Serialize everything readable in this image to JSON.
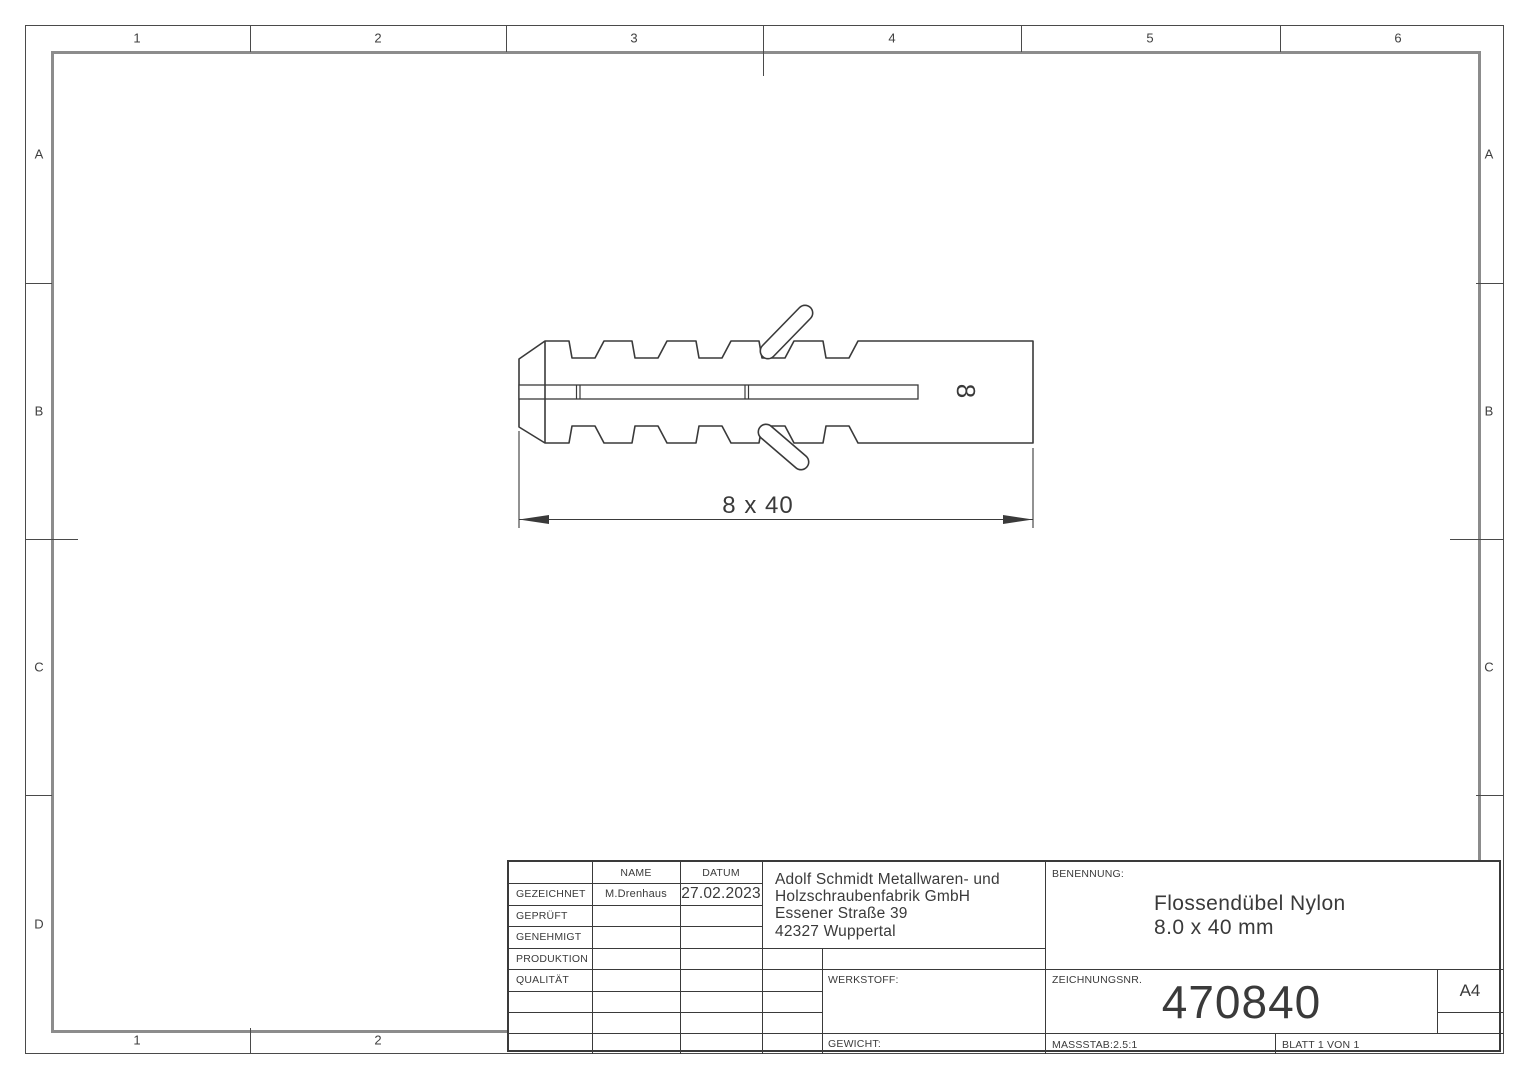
{
  "sheet": {
    "zones": {
      "columns": [
        "1",
        "2",
        "3",
        "4",
        "5",
        "6"
      ],
      "rows": [
        "A",
        "B",
        "C",
        "D"
      ],
      "bottom_columns": [
        "1",
        "2"
      ]
    },
    "colors": {
      "line": "#3a3a3a",
      "frame_inner": "#8c8c8c",
      "background": "#ffffff"
    }
  },
  "drawing": {
    "dimension_label": "8 x 40",
    "diameter_label": "8"
  },
  "title_block": {
    "header": {
      "name": "NAME",
      "datum": "DATUM"
    },
    "rows": [
      {
        "label": "GEZEICHNET",
        "name": "M.Drenhaus",
        "date": "27.02.2023"
      },
      {
        "label": "GEPRÜFT",
        "name": "",
        "date": ""
      },
      {
        "label": "GENEHMIGT",
        "name": "",
        "date": ""
      },
      {
        "label": "PRODUKTION",
        "name": "",
        "date": ""
      },
      {
        "label": "QUALITÄT",
        "name": "",
        "date": ""
      }
    ],
    "company": {
      "line1": "Adolf Schmidt Metallwaren- und",
      "line2": "Holzschraubenfabrik GmbH",
      "line3": "Essener Straße 39",
      "line4": "42327 Wuppertal"
    },
    "benennung_label": "BENENNUNG:",
    "title_line1": "Flossendübel Nylon",
    "title_line2": "8.0 x 40 mm",
    "werkstoff_label": "WERKSTOFF:",
    "gewicht_label": "GEWICHT:",
    "zeichnungsnr_label": "ZEICHNUNGSNR.",
    "drawing_number": "470840",
    "paper_size": "A4",
    "massstab": "MASSSTAB:2.5:1",
    "blatt": "BLATT 1 VON 1"
  }
}
